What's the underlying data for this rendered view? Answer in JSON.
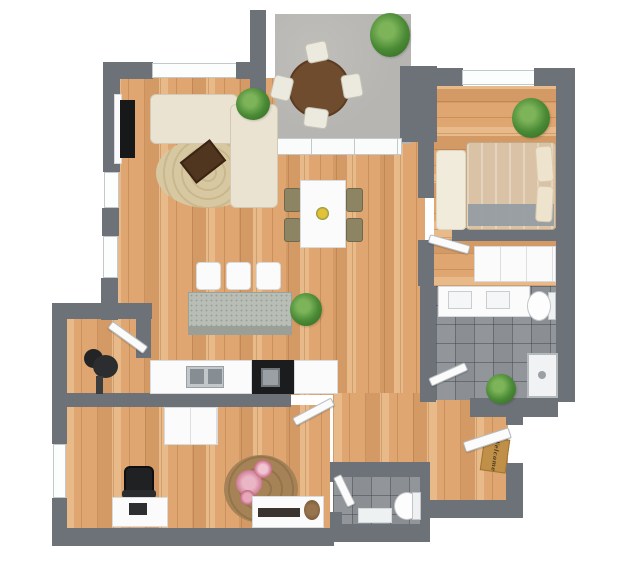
{
  "scene": {
    "canvas": {
      "w": 623,
      "h": 562,
      "bg": "#ffffff"
    },
    "doormat_text": "Welcome",
    "palette": {
      "wall": "#6d7278",
      "wood": "#e0a671",
      "concrete": "#b6b5b1",
      "tile": "#8b8f94",
      "sofa_cream": "#ebe3d2",
      "bed_tan": "#d9c2a6",
      "table_brown": "#5d4027",
      "white_furniture": "#fbfbfc",
      "black": "#1b1c1e",
      "plant_green": "#4a8a35",
      "rug_jute": "#d8c8a2",
      "rug_floral": "#a68257",
      "doormat": "#c09048",
      "flower_pink": "#cd7b93",
      "centerpiece_yellow": "#e3c23a",
      "island_granite": "#b8bdb6"
    },
    "rooms": [
      {
        "name": "living-room",
        "floor": "wood"
      },
      {
        "name": "dining-area",
        "floor": "wood"
      },
      {
        "name": "kitchen",
        "floor": "wood"
      },
      {
        "name": "balcony",
        "floor": "concrete"
      },
      {
        "name": "bedroom",
        "floor": "wood"
      },
      {
        "name": "bathroom",
        "floor": "tile"
      },
      {
        "name": "home-office",
        "floor": "wood"
      },
      {
        "name": "wc",
        "floor": "tile"
      },
      {
        "name": "entry-hall",
        "floor": "wood"
      },
      {
        "name": "nook",
        "floor": "wood"
      }
    ],
    "objects": [
      {
        "n": "living-floor",
        "t": "wood-v",
        "x": 112,
        "y": 78,
        "w": 313,
        "h": 317
      },
      {
        "n": "hall-floor",
        "t": "wood-v",
        "x": 333,
        "y": 393,
        "w": 95,
        "h": 72
      },
      {
        "n": "entry-floor",
        "t": "wood-v",
        "x": 428,
        "y": 398,
        "w": 80,
        "h": 105
      },
      {
        "n": "nook-floor",
        "t": "wood-v",
        "x": 65,
        "y": 318,
        "w": 73,
        "h": 78
      },
      {
        "n": "office-floor",
        "t": "wood-v",
        "x": 65,
        "y": 405,
        "w": 265,
        "h": 126
      },
      {
        "n": "bedroom-floor",
        "t": "wood-h",
        "x": 434,
        "y": 86,
        "w": 124,
        "h": 144
      },
      {
        "n": "closet-floor",
        "t": "wood-h",
        "x": 434,
        "y": 230,
        "w": 124,
        "h": 56
      },
      {
        "n": "bathroom-floor",
        "t": "tile",
        "x": 436,
        "y": 286,
        "w": 122,
        "h": 114
      },
      {
        "n": "wc-floor",
        "t": "tile",
        "x": 333,
        "y": 476,
        "w": 90,
        "h": 50
      },
      {
        "n": "balcony-floor",
        "t": "concrete",
        "x": 275,
        "y": 14,
        "w": 136,
        "h": 130
      },
      {
        "n": "wall-living-top-left",
        "t": "wall",
        "x": 103,
        "y": 62,
        "w": 50,
        "h": 17
      },
      {
        "n": "window-living-top",
        "t": "win",
        "x": 152,
        "y": 63,
        "w": 85,
        "h": 15
      },
      {
        "n": "wall-living-top-right",
        "t": "wall",
        "x": 236,
        "y": 62,
        "w": 30,
        "h": 17
      },
      {
        "n": "wall-balcony-left",
        "t": "wall",
        "x": 250,
        "y": 10,
        "w": 16,
        "h": 136
      },
      {
        "n": "wall-balcony-right",
        "t": "wall",
        "x": 400,
        "y": 66,
        "w": 37,
        "h": 76
      },
      {
        "n": "wall-bedroom-top-left",
        "t": "wall",
        "x": 437,
        "y": 68,
        "w": 26,
        "h": 18
      },
      {
        "n": "window-bedroom",
        "t": "win",
        "x": 462,
        "y": 70,
        "w": 73,
        "h": 15
      },
      {
        "n": "wall-bedroom-top-right",
        "t": "wall",
        "x": 534,
        "y": 68,
        "w": 24,
        "h": 18
      },
      {
        "n": "wall-right",
        "t": "wall",
        "x": 556,
        "y": 68,
        "w": 19,
        "h": 334
      },
      {
        "n": "wall-left-upper-a",
        "t": "wall",
        "x": 103,
        "y": 75,
        "w": 17,
        "h": 97
      },
      {
        "n": "window-left-1",
        "t": "win",
        "x": 104,
        "y": 172,
        "w": 15,
        "h": 36
      },
      {
        "n": "wall-left-upper-b",
        "t": "wall",
        "x": 102,
        "y": 208,
        "w": 17,
        "h": 28
      },
      {
        "n": "window-left-2",
        "t": "win",
        "x": 103,
        "y": 236,
        "w": 15,
        "h": 42
      },
      {
        "n": "wall-left-upper-c",
        "t": "wall",
        "x": 101,
        "y": 278,
        "w": 17,
        "h": 42
      },
      {
        "n": "wall-nook-top",
        "t": "wall",
        "x": 52,
        "y": 303,
        "w": 100,
        "h": 16
      },
      {
        "n": "wall-nook-right",
        "t": "wall",
        "x": 136,
        "y": 318,
        "w": 15,
        "h": 40
      },
      {
        "n": "door-nook",
        "t": "door",
        "x": 110,
        "y": 320,
        "w": 44,
        "h": 9,
        "rot": 36,
        "o": "left center"
      },
      {
        "n": "wall-left-lower-a",
        "t": "wall",
        "x": 52,
        "y": 318,
        "w": 15,
        "h": 126
      },
      {
        "n": "window-office",
        "t": "win",
        "x": 53,
        "y": 444,
        "w": 13,
        "h": 54
      },
      {
        "n": "wall-left-lower-b",
        "t": "wall",
        "x": 52,
        "y": 498,
        "w": 15,
        "h": 38
      },
      {
        "n": "wall-office-bottom",
        "t": "wall",
        "x": 52,
        "y": 528,
        "w": 282,
        "h": 18
      },
      {
        "n": "wall-kitchen",
        "t": "wall",
        "x": 65,
        "y": 393,
        "w": 226,
        "h": 14
      },
      {
        "n": "door-office",
        "t": "door",
        "x": 289,
        "y": 397,
        "w": 44,
        "h": 9,
        "rot": -28,
        "o": "right center"
      },
      {
        "n": "wall-hall-bedroom",
        "t": "wall",
        "x": 418,
        "y": 142,
        "w": 16,
        "h": 56
      },
      {
        "n": "wall-hall-bathroom",
        "t": "wall",
        "x": 418,
        "y": 240,
        "w": 16,
        "h": 46
      },
      {
        "n": "door-bedroom",
        "t": "door",
        "x": 429,
        "y": 234,
        "w": 42,
        "h": 9,
        "rot": 16,
        "o": "left center"
      },
      {
        "n": "wall-bathroom-left",
        "t": "wall",
        "x": 420,
        "y": 286,
        "w": 16,
        "h": 116
      },
      {
        "n": "wall-bedroom-south",
        "t": "wall",
        "x": 452,
        "y": 228,
        "w": 106,
        "h": 13
      },
      {
        "n": "wall-bathroom-bottom",
        "t": "wall",
        "x": 470,
        "y": 398,
        "w": 88,
        "h": 19
      },
      {
        "n": "door-bathroom",
        "t": "door",
        "x": 430,
        "y": 378,
        "w": 40,
        "h": 9,
        "rot": -24,
        "o": "left center"
      },
      {
        "n": "wall-entry-right-stub",
        "t": "wall",
        "x": 506,
        "y": 415,
        "w": 17,
        "h": 10
      },
      {
        "n": "wall-entry-right",
        "t": "wall",
        "x": 506,
        "y": 463,
        "w": 17,
        "h": 55
      },
      {
        "n": "wall-entry-bottom",
        "t": "wall",
        "x": 424,
        "y": 500,
        "w": 99,
        "h": 18
      },
      {
        "n": "wall-wc-bottom",
        "t": "wall",
        "x": 330,
        "y": 524,
        "w": 100,
        "h": 18
      },
      {
        "n": "wall-wc-top",
        "t": "wall",
        "x": 330,
        "y": 462,
        "w": 92,
        "h": 15
      },
      {
        "n": "wall-wc-left-a",
        "t": "wall",
        "x": 330,
        "y": 476,
        "w": 12,
        "h": 6
      },
      {
        "n": "door-wc",
        "t": "door",
        "x": 333,
        "y": 478,
        "w": 9,
        "h": 33,
        "rot": -26,
        "o": "top left"
      },
      {
        "n": "wall-wc-left-b",
        "t": "wall",
        "x": 330,
        "y": 512,
        "w": 12,
        "h": 16
      },
      {
        "n": "wall-wc-right",
        "t": "wall",
        "x": 420,
        "y": 462,
        "w": 10,
        "h": 62
      },
      {
        "n": "sliding-door-balcony",
        "t": "glass",
        "x": 268,
        "y": 138,
        "w": 134,
        "h": 17
      },
      {
        "n": "balcony-plant",
        "t": "plant",
        "x": 370,
        "y": 13,
        "w": 40,
        "h": 44
      },
      {
        "n": "balcony-table",
        "x": 288,
        "y": 58,
        "w": 62,
        "h": 60,
        "c": "#6f4c2d",
        "r": "50%",
        "b": "2px solid #5b3c22"
      },
      {
        "n": "balcony-chair-top",
        "t": "chair",
        "x": 306,
        "y": 42,
        "w": 22,
        "h": 20,
        "rot": -12
      },
      {
        "n": "balcony-chair-left",
        "t": "chair",
        "x": 272,
        "y": 76,
        "w": 20,
        "h": 24,
        "rot": 14
      },
      {
        "n": "balcony-chair-bottom",
        "t": "chair",
        "x": 304,
        "y": 108,
        "w": 24,
        "h": 20,
        "rot": 8
      },
      {
        "n": "balcony-chair-right",
        "t": "chair",
        "x": 342,
        "y": 74,
        "w": 20,
        "h": 24,
        "rot": -10
      },
      {
        "n": "living-rug",
        "t": "rug-jute",
        "x": 156,
        "y": 138,
        "w": 104,
        "h": 70
      },
      {
        "n": "tv-shelf",
        "t": "white",
        "x": 114,
        "y": 94,
        "w": 8,
        "h": 70
      },
      {
        "n": "tv",
        "x": 120,
        "y": 100,
        "w": 15,
        "h": 58,
        "c": "#17181a"
      },
      {
        "n": "sofa-main",
        "t": "sofa",
        "x": 150,
        "y": 94,
        "w": 88,
        "h": 50
      },
      {
        "n": "sofa-chaise",
        "t": "sofa",
        "x": 230,
        "y": 104,
        "w": 48,
        "h": 104
      },
      {
        "n": "sofa-plant",
        "t": "plant",
        "x": 236,
        "y": 88,
        "w": 34,
        "h": 32
      },
      {
        "n": "coffee-table",
        "x": 184,
        "y": 148,
        "w": 38,
        "h": 27,
        "c": "#50351f",
        "rot": -38,
        "b": "2px solid #3a2413"
      },
      {
        "n": "dining-chair-1",
        "t": "dchair",
        "x": 284,
        "y": 188,
        "w": 17,
        "h": 24
      },
      {
        "n": "dining-chair-2",
        "t": "dchair",
        "x": 284,
        "y": 218,
        "w": 17,
        "h": 24
      },
      {
        "n": "dining-chair-3",
        "t": "dchair",
        "x": 346,
        "y": 188,
        "w": 17,
        "h": 24
      },
      {
        "n": "dining-chair-4",
        "t": "dchair",
        "x": 346,
        "y": 218,
        "w": 17,
        "h": 24
      },
      {
        "n": "dining-table",
        "t": "white",
        "x": 300,
        "y": 180,
        "w": 46,
        "h": 68
      },
      {
        "n": "dining-centerpiece",
        "x": 316,
        "y": 207,
        "w": 13,
        "h": 13,
        "c": "radial-gradient(circle,#e3c23a 0 45%,#7a8c3a 75%)",
        "r": "50%"
      },
      {
        "n": "bar-stool-1",
        "t": "white",
        "x": 196,
        "y": 262,
        "w": 25,
        "h": 28,
        "r": "4px"
      },
      {
        "n": "bar-stool-2",
        "t": "white",
        "x": 226,
        "y": 262,
        "w": 25,
        "h": 28,
        "r": "4px"
      },
      {
        "n": "bar-stool-3",
        "t": "white",
        "x": 256,
        "y": 262,
        "w": 25,
        "h": 28,
        "r": "4px"
      },
      {
        "n": "kitchen-island",
        "t": "granite",
        "x": 188,
        "y": 292,
        "w": 104,
        "h": 36
      },
      {
        "n": "island-front",
        "x": 188,
        "y": 326,
        "w": 104,
        "h": 9,
        "c": "#9aa098"
      },
      {
        "n": "island-plant",
        "t": "plant",
        "x": 290,
        "y": 293,
        "w": 32,
        "h": 33
      },
      {
        "n": "kitchen-counter-left",
        "t": "white",
        "x": 150,
        "y": 360,
        "w": 102,
        "h": 34
      },
      {
        "n": "kitchen-counter-black",
        "x": 252,
        "y": 360,
        "w": 42,
        "h": 34,
        "c": "#1b1c1e"
      },
      {
        "n": "kitchen-oven",
        "x": 261,
        "y": 368,
        "w": 19,
        "h": 19,
        "c": "#9aa0a4",
        "b": "2px solid #70767a"
      },
      {
        "n": "kitchen-counter-right",
        "t": "white",
        "x": 294,
        "y": 360,
        "w": 44,
        "h": 34
      },
      {
        "n": "kitchen-sink",
        "x": 186,
        "y": 366,
        "w": 38,
        "h": 22,
        "c": "#c2c7ca",
        "b": "1px solid #9aa0a3"
      },
      {
        "n": "sink-basin-left",
        "x": 190,
        "y": 369,
        "w": 14,
        "h": 15,
        "c": "#878e93"
      },
      {
        "n": "sink-basin-right",
        "x": 208,
        "y": 369,
        "w": 14,
        "h": 15,
        "c": "#878e93"
      },
      {
        "n": "floor-lamp-shade",
        "x": 84,
        "y": 349,
        "w": 19,
        "h": 19,
        "c": "#222426",
        "r": "50%"
      },
      {
        "n": "floor-lamp-body",
        "x": 93,
        "y": 355,
        "w": 25,
        "h": 23,
        "c": "#2b2d2f",
        "r": "50%"
      },
      {
        "n": "floor-lamp-base",
        "x": 96,
        "y": 376,
        "w": 7,
        "h": 18,
        "c": "#3a3c3e"
      },
      {
        "n": "office-wardrobe",
        "t": "wdoors",
        "x": 164,
        "y": 407,
        "w": 54,
        "h": 38
      },
      {
        "n": "office-rug",
        "t": "rug-floral",
        "x": 224,
        "y": 455,
        "w": 74,
        "h": 68
      },
      {
        "n": "rug-flowers-1",
        "x": 236,
        "y": 470,
        "w": 26,
        "h": 26,
        "c": "radial-gradient(circle,#eab6c6 0 35%,#cd7b93 70%,rgba(0,0,0,0) 75%)",
        "r": "50%"
      },
      {
        "n": "rug-flowers-2",
        "x": 254,
        "y": 460,
        "w": 18,
        "h": 18,
        "c": "radial-gradient(circle,#f0c4d2 0 35%,#c96a85 70%,rgba(0,0,0,0) 75%)",
        "r": "50%"
      },
      {
        "n": "rug-flowers-3",
        "x": 240,
        "y": 490,
        "w": 15,
        "h": 15,
        "c": "radial-gradient(circle,#e7a8ba 0 40%,#b95a75 75%,rgba(0,0,0,0) 80%)",
        "r": "50%"
      },
      {
        "n": "office-chair",
        "x": 124,
        "y": 466,
        "w": 30,
        "h": 30,
        "c": "#1f2123",
        "r": "6px",
        "b": "2px solid #0e0f10"
      },
      {
        "n": "office-chair-back",
        "x": 122,
        "y": 490,
        "w": 34,
        "h": 8,
        "c": "#2a2c2e",
        "r": "3px"
      },
      {
        "n": "office-desk",
        "t": "white",
        "x": 112,
        "y": 497,
        "w": 56,
        "h": 30
      },
      {
        "n": "laptop",
        "x": 129,
        "y": 503,
        "w": 18,
        "h": 12,
        "c": "#2c2e30"
      },
      {
        "n": "office-sideboard",
        "t": "white",
        "x": 252,
        "y": 496,
        "w": 72,
        "h": 32
      },
      {
        "n": "sideboard-decor",
        "x": 258,
        "y": 508,
        "w": 42,
        "h": 9,
        "c": "#3a3330"
      },
      {
        "n": "sideboard-twigs",
        "x": 304,
        "y": 500,
        "w": 16,
        "h": 20,
        "c": "radial-gradient(circle,#97744e 0 40%,#7a5a38 80%)",
        "r": "50%"
      },
      {
        "n": "wc-toilet-bowl",
        "x": 394,
        "y": 492,
        "w": 26,
        "h": 28,
        "c": "#fdfdfd",
        "r": "50%",
        "b": "1px solid #c0c5c8"
      },
      {
        "n": "wc-toilet-tank",
        "x": 412,
        "y": 492,
        "w": 9,
        "h": 28,
        "c": "#eef0f1",
        "b": "1px solid #c0c5c8"
      },
      {
        "n": "wc-mat",
        "x": 358,
        "y": 508,
        "w": 34,
        "h": 15,
        "c": "#eef1f2",
        "b": "1px solid #d5d9db"
      },
      {
        "n": "vanity",
        "t": "white",
        "x": 438,
        "y": 286,
        "w": 92,
        "h": 31
      },
      {
        "n": "vanity-sink-left",
        "x": 448,
        "y": 291,
        "w": 24,
        "h": 18,
        "c": "#f4f6f7",
        "b": "1px solid #c8cdd0"
      },
      {
        "n": "vanity-sink-right",
        "x": 486,
        "y": 291,
        "w": 24,
        "h": 18,
        "c": "#f4f6f7",
        "b": "1px solid #c8cdd0"
      },
      {
        "n": "bath-toilet-tank",
        "x": 548,
        "y": 292,
        "w": 8,
        "h": 28,
        "c": "#eef0f1",
        "b": "1px solid #c0c5c8"
      },
      {
        "n": "bath-toilet-bowl",
        "x": 527,
        "y": 291,
        "w": 24,
        "h": 30,
        "c": "#fdfdfd",
        "r": "50%",
        "b": "1px solid #c0c5c8"
      },
      {
        "n": "shower-tray",
        "x": 527,
        "y": 353,
        "w": 31,
        "h": 45,
        "c": "#f0f2f3",
        "b": "2px solid #b4b9bc"
      },
      {
        "n": "shower-drain",
        "x": 538,
        "y": 371,
        "w": 8,
        "h": 8,
        "c": "#9aa0a3",
        "r": "50%"
      },
      {
        "n": "bathroom-plant",
        "t": "plant",
        "x": 486,
        "y": 374,
        "w": 30,
        "h": 30
      },
      {
        "n": "bedroom-rug",
        "x": 436,
        "y": 150,
        "w": 30,
        "h": 80,
        "c": "#f1ebdb",
        "r": "4px",
        "b": "1px solid #ded6c0"
      },
      {
        "n": "bed",
        "t": "bed",
        "x": 466,
        "y": 142,
        "w": 90,
        "h": 88
      },
      {
        "n": "bed-throw",
        "x": 468,
        "y": 204,
        "w": 86,
        "h": 22,
        "c": "rgba(148,156,162,0.92)"
      },
      {
        "n": "bed-pillow-1",
        "x": 536,
        "y": 146,
        "w": 17,
        "h": 36,
        "c": "#eee3cd",
        "r": "4px",
        "rot": -4,
        "b": "1px solid #d9cbab"
      },
      {
        "n": "bed-pillow-2",
        "x": 536,
        "y": 186,
        "w": 17,
        "h": 36,
        "c": "#eee3cd",
        "r": "4px",
        "rot": 3,
        "b": "1px solid #d9cbab"
      },
      {
        "n": "bedroom-plant",
        "t": "plant",
        "x": 512,
        "y": 98,
        "w": 38,
        "h": 40
      },
      {
        "n": "bedroom-wardrobe",
        "t": "wdoors",
        "x": 474,
        "y": 246,
        "w": 82,
        "h": 36
      },
      {
        "n": "doormat",
        "t": "mat-text",
        "x": 482,
        "y": 438,
        "w": 26,
        "h": 34,
        "c": "#c09048",
        "rot": 8,
        "b": "1px solid #9e7433",
        "bind": "scene.doormat_text"
      },
      {
        "n": "door-entry",
        "t": "door",
        "x": 462,
        "y": 427,
        "w": 48,
        "h": 11,
        "rot": -18,
        "o": "right center",
        "z": 5
      }
    ]
  }
}
